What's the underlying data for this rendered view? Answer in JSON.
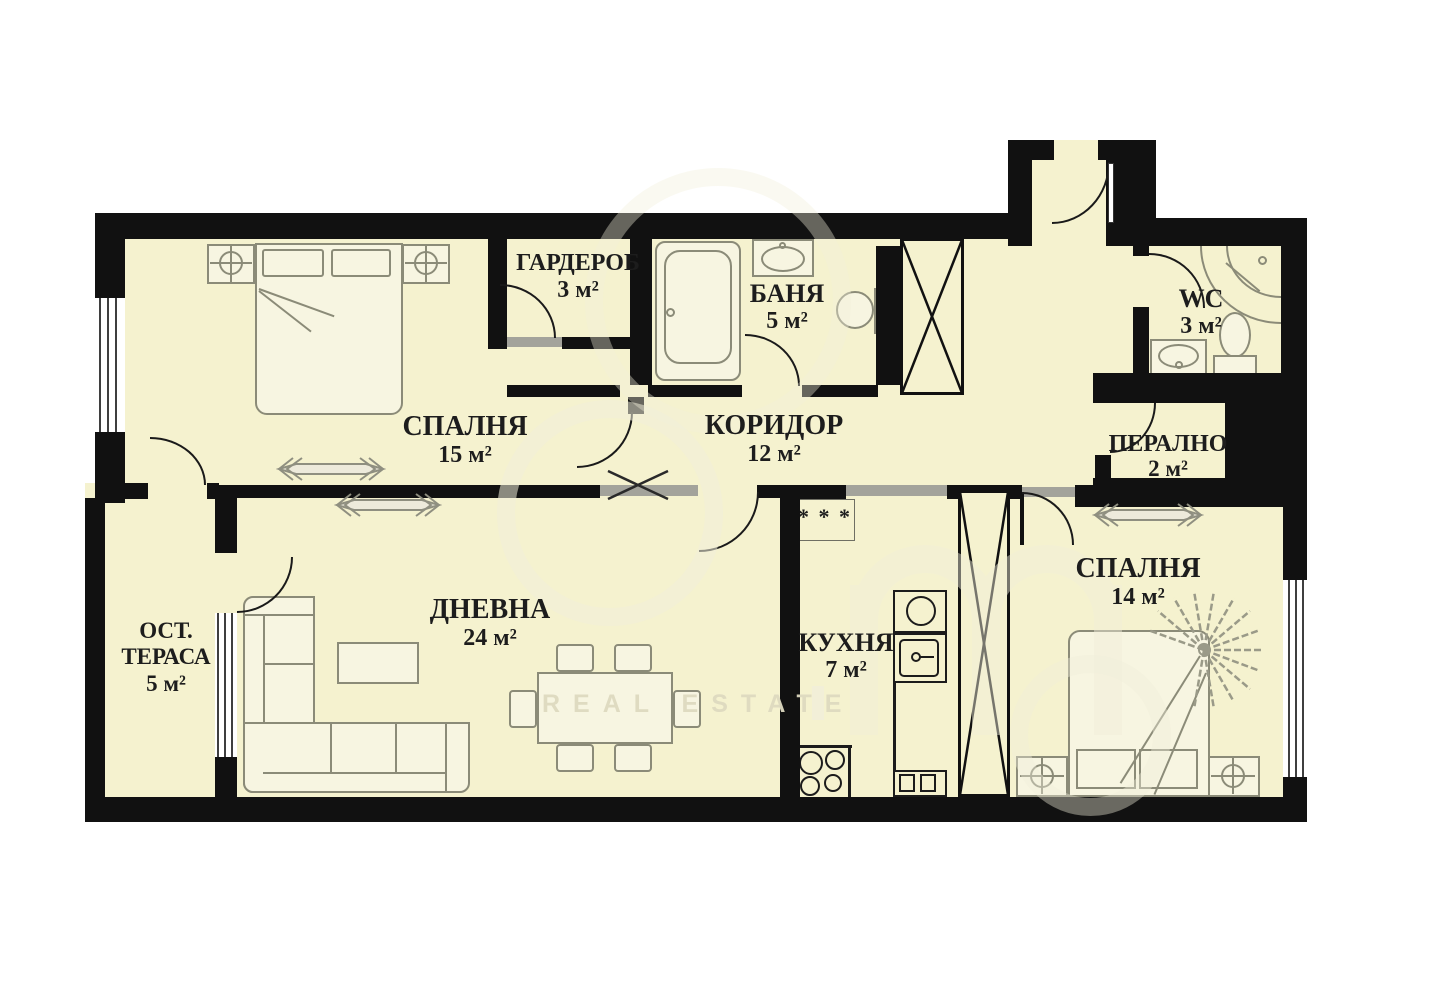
{
  "rooms": [
    {
      "name": "СПАЛНЯ",
      "area": "15 м²"
    },
    {
      "name": "ГАРДЕРОБ",
      "area": "3 м²"
    },
    {
      "name": "БАНЯ",
      "area": "5 м²"
    },
    {
      "name": "КОРИДОР",
      "area": "12 м²"
    },
    {
      "name": "WC",
      "area": "3 м²"
    },
    {
      "name": "ПЕРАЛНО",
      "area": "2 м²"
    },
    {
      "name": "СПАЛНЯ",
      "area": "14 м²"
    },
    {
      "name": "КУХНЯ",
      "area": "7 м²"
    },
    {
      "name": "ДНЕВНА",
      "area": "24 м²"
    },
    {
      "line1": "ОСТ.",
      "line2": "ТЕРАСА",
      "area": "5 м²"
    }
  ],
  "symbols": {
    "boiler": "* * *"
  },
  "watermark": {
    "tagline": "REAL ESTATE"
  },
  "colors": {
    "floor": "#f5f2cf",
    "wall": "#111111",
    "furniture_line": "#8b8b78",
    "label": "#1d1d1d",
    "opening": "#a3a39b"
  }
}
